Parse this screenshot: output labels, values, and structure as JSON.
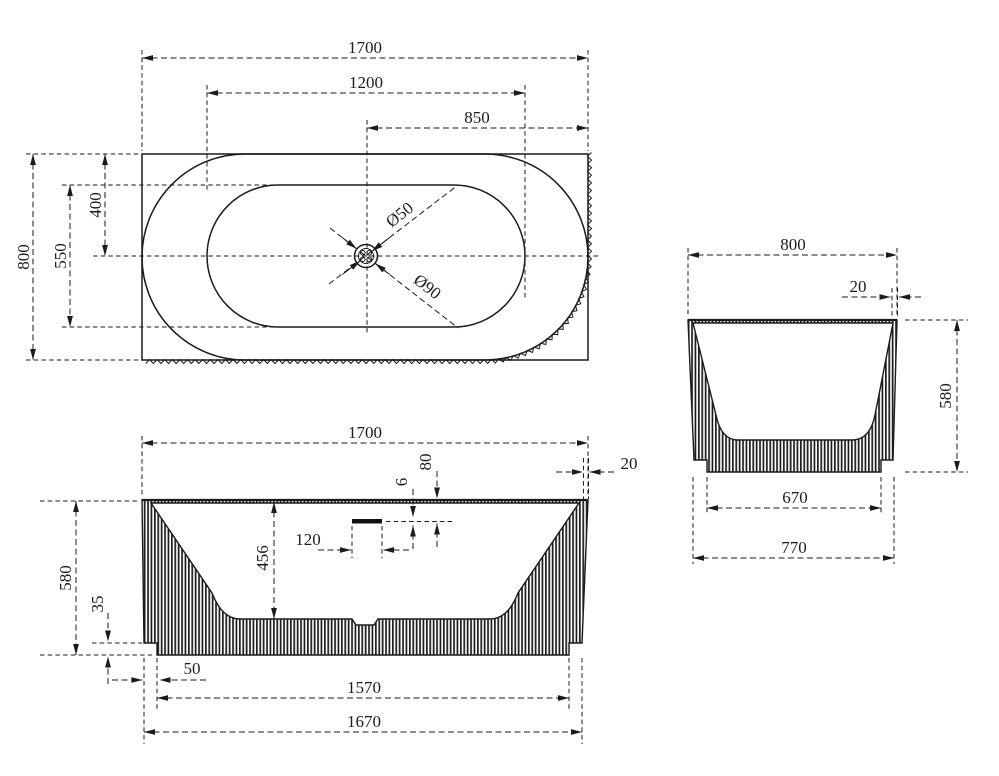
{
  "colors": {
    "line": "#1b1b1b",
    "background": "#ffffff"
  },
  "top_view": {
    "length_overall": "1700",
    "length_inner": "1200",
    "drain_to_end": "850",
    "width_overall": "800",
    "width_inner": "550",
    "drain_from_back": "400",
    "drain_hole": "Ø50",
    "drain_recess": "Ø90"
  },
  "front_view": {
    "length_overall": "1700",
    "rim_thickness": "20",
    "overflow_from_rim": "80",
    "overflow_slot": "6",
    "overflow_width": "120",
    "depth_inner": "456",
    "height_overall": "580",
    "plinth_height": "35",
    "plinth_inset": "50",
    "plinth_length": "1570",
    "base_length": "1670"
  },
  "side_view": {
    "width_overall": "800",
    "rim_thickness": "20",
    "height_overall": "580",
    "plinth_width": "670",
    "base_width": "770"
  }
}
